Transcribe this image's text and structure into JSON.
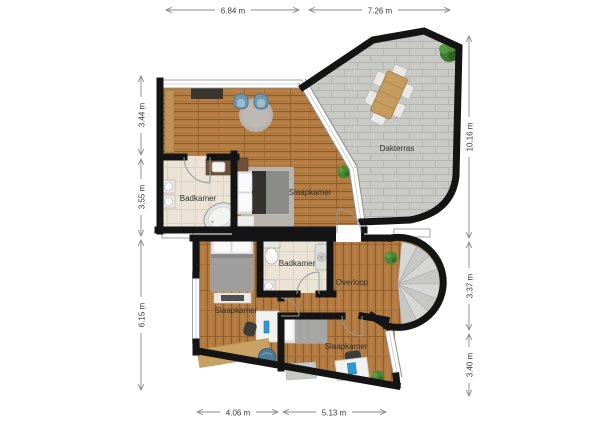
{
  "floorplan": {
    "rooms": {
      "bathroom_upper": "Badkamer",
      "bedroom_upper": "Slaapkamer",
      "terrace": "Dakterras",
      "bathroom_lower": "Badkamer",
      "landing": "Overloop",
      "bedroom_lower_left": "Slaapkamer",
      "bedroom_lower_right": "Slaapkamer"
    },
    "dimensions": {
      "top": [
        "6.84 m",
        "7.26 m"
      ],
      "left": [
        "3.44 m",
        "3.55 m",
        "6.15 m"
      ],
      "right": [
        "10.16 m",
        "3.37 m",
        "3.40 m"
      ],
      "bottom": [
        "4.06 m",
        "5.13 m"
      ]
    },
    "colors": {
      "wall": "#141414",
      "wood_floor": "#b27a40",
      "terrace_tile": "#c9c9c6",
      "bathroom_floor": "#eae3d6",
      "plant_green": "#4c8534",
      "chair_blue": "#7097ae",
      "dimension_text": "#3a3a3a"
    }
  }
}
